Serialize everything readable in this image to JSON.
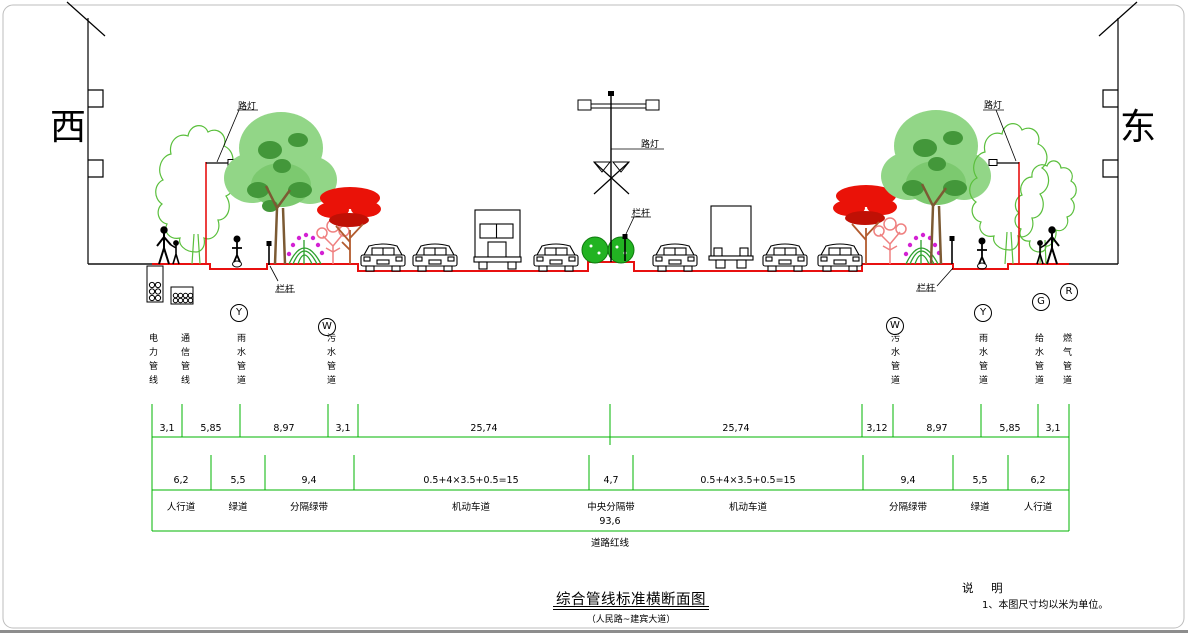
{
  "compass": {
    "west": "西",
    "east": "东"
  },
  "annotations": {
    "lamp_left": "路灯",
    "lamp_center": "路灯",
    "lamp_right": "路灯",
    "railing_left": "栏杆",
    "railing_center": "栏杆",
    "railing_right": "栏杆"
  },
  "pipes": {
    "left": [
      {
        "symbol": "",
        "name": "电力管线"
      },
      {
        "symbol": "",
        "name": "通信管线"
      },
      {
        "symbol": "Y",
        "name": "雨水管道"
      },
      {
        "symbol": "W",
        "name": "污水管道"
      }
    ],
    "right": [
      {
        "symbol": "W",
        "name": "污水管道"
      },
      {
        "symbol": "Y",
        "name": "雨水管道"
      },
      {
        "symbol": "G",
        "name": "给水管道"
      },
      {
        "symbol": "R",
        "name": "燃气管道"
      }
    ]
  },
  "dimensions": {
    "row1": [
      "3,1",
      "5,85",
      "8,97",
      "3,1",
      "25,74",
      "25,74",
      "3,12",
      "8,97",
      "5,85",
      "3,1"
    ],
    "row2": [
      "6,2",
      "5,5",
      "9,4",
      "0.5+4×3.5+0.5=15",
      "4,7",
      "0.5+4×3.5+0.5=15",
      "9,4",
      "5,5",
      "6,2"
    ],
    "zones": [
      "人行道",
      "绿道",
      "分隔绿带",
      "机动车道",
      "中央分隔带",
      "机动车道",
      "分隔绿带",
      "绿道",
      "人行道"
    ],
    "total": "93,6",
    "red_line_label": "道路红线"
  },
  "title": {
    "main": "综合管线标准横断面图",
    "sub": "（人民路~建宾大道）"
  },
  "notes": {
    "heading": "说 明",
    "item": "1、本图尺寸均以米为单位。"
  },
  "colors": {
    "dimension_green": "#00b400",
    "road_red": "#e81010",
    "tree_light": "#92d687",
    "tree_dark": "#43973a",
    "red_tree": "#ea1208",
    "magenta": "#d321d3",
    "pink": "#ef8080"
  }
}
